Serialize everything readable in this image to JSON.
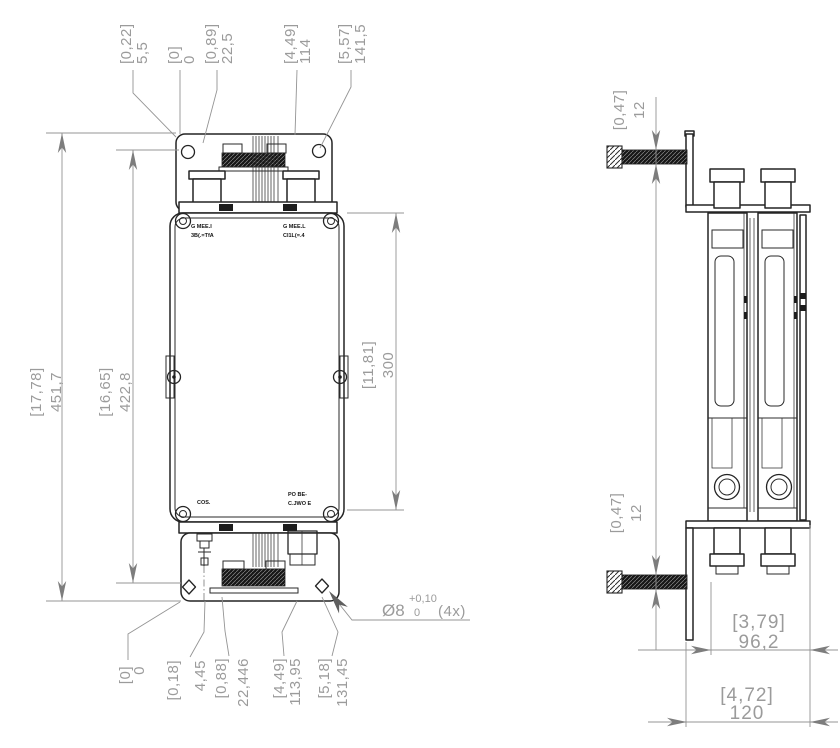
{
  "front": {
    "top_dims": [
      {
        "inch": "[0,22]",
        "mm": "5,5"
      },
      {
        "inch": "[0]",
        "mm": "0"
      },
      {
        "inch": "[0,89]",
        "mm": "22,5"
      },
      {
        "inch": "[4,49]",
        "mm": "114"
      },
      {
        "inch": "[5,57]",
        "mm": "141,5"
      }
    ],
    "height_dims": [
      {
        "inch": "[17,78]",
        "mm": "451,7"
      },
      {
        "inch": "[16,65]",
        "mm": "422,8"
      }
    ],
    "body_dim": {
      "inch": "[11,81]",
      "mm": "300"
    },
    "bottom_dims": [
      {
        "inch": "[0]",
        "mm": "0"
      },
      {
        "inch": "[0,18]",
        "mm": "4,45"
      },
      {
        "inch": "[0,88]",
        "mm": "22,446"
      },
      {
        "inch": "[4,49]",
        "mm": "113,95"
      },
      {
        "inch": "[5,18]",
        "mm": "131,45"
      }
    ],
    "hole_callout": {
      "diameter": "Ø8",
      "tol_plus": "+0,10",
      "tol_minus": "0",
      "qty": "(4x)"
    },
    "markings": {
      "top_left_1": "G MEE.I",
      "top_left_2": "3B(.=TfA",
      "top_right_1": "G MEE.L",
      "top_right_2": "CI1L(=.4",
      "bottom_left": "COS.",
      "bottom_right_1": "PO BE-",
      "bottom_right_2": "C.JWO E"
    }
  },
  "side": {
    "screw_dims": [
      {
        "inch": "[0,47]",
        "mm": "12"
      },
      {
        "inch": "[0,47]",
        "mm": "12"
      }
    ],
    "width_dims": [
      {
        "inch": "[3,79]",
        "mm": "96,2"
      },
      {
        "inch": "[4,72]",
        "mm": "120"
      }
    ]
  },
  "colors": {
    "object_line": "#242424",
    "dim_line": "#949494",
    "dim_text": "#9b9b9b",
    "arrow": "#7d7d7d",
    "background": "#ffffff"
  }
}
